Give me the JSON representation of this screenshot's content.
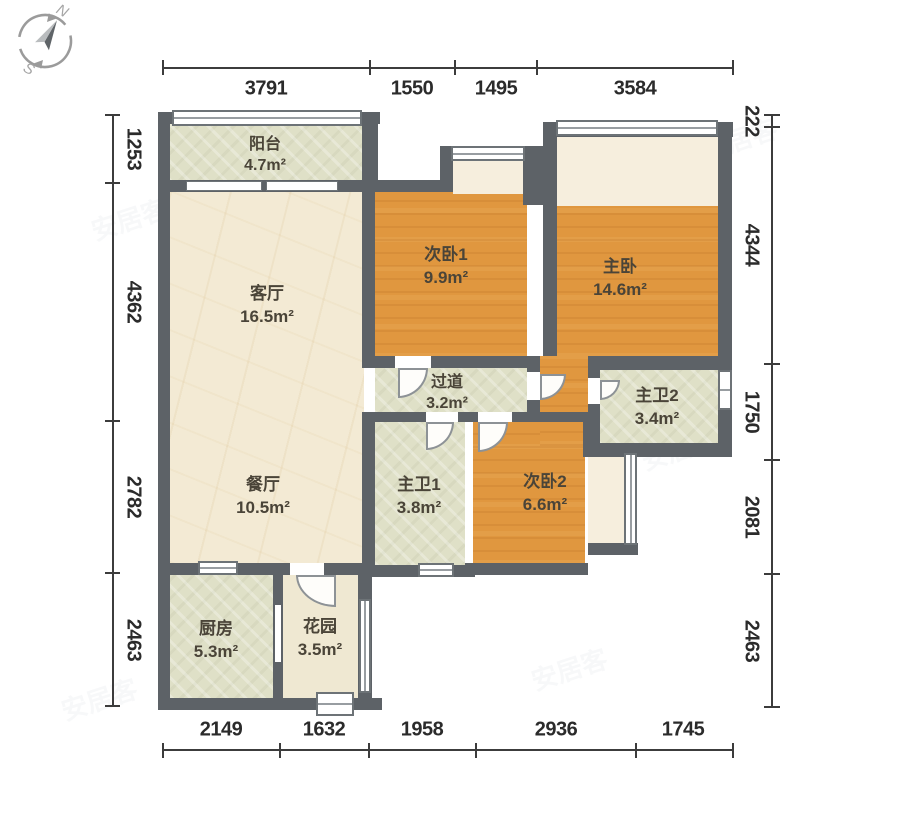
{
  "compass": {
    "north": "N",
    "south": "S"
  },
  "watermark": {
    "text": "安居客"
  },
  "colors": {
    "wall": "#5d6267",
    "wood_floor": "#e0973f",
    "marble_floor": "#f3ead4",
    "tile_floor": "#dfe0c7",
    "bay_floor": "#f6eedd",
    "dimension_text": "#2b2b2b"
  },
  "rooms": [
    {
      "id": "balcony",
      "name": "阳台",
      "area": "4.7m²"
    },
    {
      "id": "living",
      "name": "客厅",
      "area": "16.5m²"
    },
    {
      "id": "dining",
      "name": "餐厅",
      "area": "10.5m²"
    },
    {
      "id": "kitchen",
      "name": "厨房",
      "area": "5.3m²"
    },
    {
      "id": "garden",
      "name": "花园",
      "area": "3.5m²"
    },
    {
      "id": "bedroom1",
      "name": "次卧1",
      "area": "9.9m²"
    },
    {
      "id": "master",
      "name": "主卧",
      "area": "14.6m²"
    },
    {
      "id": "hallway",
      "name": "过道",
      "area": "3.2m²"
    },
    {
      "id": "bath1",
      "name": "主卫1",
      "area": "3.8m²"
    },
    {
      "id": "bedroom2",
      "name": "次卧2",
      "area": "6.6m²"
    },
    {
      "id": "bath2",
      "name": "主卫2",
      "area": "3.4m²"
    }
  ],
  "dimensions": {
    "top": [
      "3791",
      "1550",
      "1495",
      "3584"
    ],
    "bottom": [
      "2149",
      "1632",
      "1958",
      "2936",
      "1745"
    ],
    "left": [
      "1253",
      "4362",
      "2782",
      "2463"
    ],
    "right": [
      "222",
      "4344",
      "1750",
      "2081",
      "2463"
    ]
  }
}
